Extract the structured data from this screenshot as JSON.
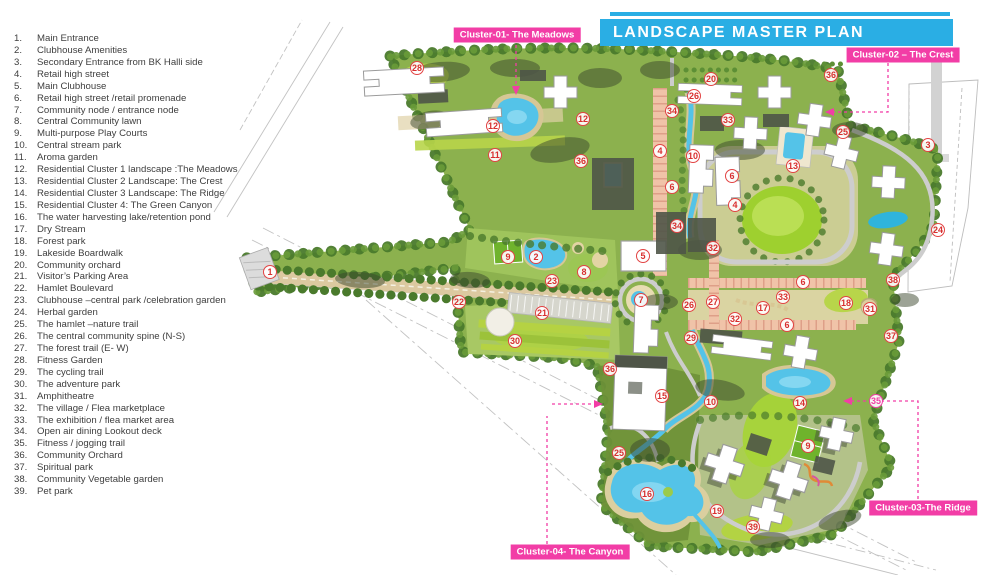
{
  "title": "LANDSCAPE MASTER PLAN",
  "colors": {
    "banner_cyan": "#2aaee4",
    "cluster_label_magenta": "#f23da6",
    "marker_red": "#d82f2f",
    "site_green": "#8cb14e",
    "water_blue": "#54c3e8"
  },
  "legend": {
    "items": [
      {
        "n": "1.",
        "t": "Main Entrance"
      },
      {
        "n": "2.",
        "t": "Clubhouse Amenities"
      },
      {
        "n": "3.",
        "t": "Secondary Entrance from BK Halli side"
      },
      {
        "n": "4.",
        "t": "Retail high street"
      },
      {
        "n": "5.",
        "t": "Main Clubhouse"
      },
      {
        "n": "6.",
        "t": "Retail high street /retail promenade"
      },
      {
        "n": "7.",
        "t": "Community node / entrance node"
      },
      {
        "n": "8.",
        "t": "Central Community lawn"
      },
      {
        "n": "9.",
        "t": "Multi-purpose Play Courts"
      },
      {
        "n": "10.",
        "t": "Central stream park"
      },
      {
        "n": "11.",
        "t": "Aroma garden"
      },
      {
        "n": "12.",
        "t": "Residential Cluster 1 landscape :The Meadows"
      },
      {
        "n": "13.",
        "t": "Residential Cluster 2 Landscape: The Crest"
      },
      {
        "n": "14.",
        "t": "Residential Cluster 3 Landscape: The Ridge"
      },
      {
        "n": "15.",
        "t": "Residential Cluster 4: The Green Canyon"
      },
      {
        "n": "16.",
        "t": "The water harvesting lake/retention pond"
      },
      {
        "n": "17.",
        "t": "Dry Stream"
      },
      {
        "n": "18.",
        "t": "Forest park"
      },
      {
        "n": "19.",
        "t": "Lakeside Boardwalk"
      },
      {
        "n": "20.",
        "t": "Community orchard"
      },
      {
        "n": "21.",
        "t": "Visitor’s Parking Area"
      },
      {
        "n": "22.",
        "t": "Hamlet Boulevard"
      },
      {
        "n": "23.",
        "t": "Clubhouse –central park /celebration garden"
      },
      {
        "n": "24.",
        "t": "Herbal garden"
      },
      {
        "n": "25.",
        "t": "The hamlet –nature trail"
      },
      {
        "n": "26.",
        "t": "The central community spine  (N-S)"
      },
      {
        "n": "27.",
        "t": "The forest trail (E- W)"
      },
      {
        "n": "28.",
        "t": "Fitness Garden"
      },
      {
        "n": "29.",
        "t": "The cycling trail"
      },
      {
        "n": "30.",
        "t": "The adventure park"
      },
      {
        "n": "31.",
        "t": "Amphitheatre"
      },
      {
        "n": "32.",
        "t": "The village / Flea  marketplace"
      },
      {
        "n": "33.",
        "t": "The exhibition / flea market area"
      },
      {
        "n": "34.",
        "t": "Open air dining Lookout deck"
      },
      {
        "n": "35.",
        "t": "Fitness / jogging trail"
      },
      {
        "n": "36.",
        "t": "Community Orchard"
      },
      {
        "n": "37.",
        "t": "Spiritual park"
      },
      {
        "n": "38.",
        "t": "Community Vegetable garden"
      },
      {
        "n": "39.",
        "t": "Pet park"
      }
    ]
  },
  "map": {
    "markers": [
      {
        "n": "28",
        "x": 417,
        "y": 68
      },
      {
        "n": "12",
        "x": 493,
        "y": 126
      },
      {
        "n": "11",
        "x": 495,
        "y": 155
      },
      {
        "n": "12",
        "x": 583,
        "y": 119
      },
      {
        "n": "36",
        "x": 581,
        "y": 161
      },
      {
        "n": "20",
        "x": 711,
        "y": 79
      },
      {
        "n": "26",
        "x": 694,
        "y": 96
      },
      {
        "n": "34",
        "x": 672,
        "y": 111
      },
      {
        "n": "33",
        "x": 728,
        "y": 120
      },
      {
        "n": "36",
        "x": 831,
        "y": 75
      },
      {
        "n": "25",
        "x": 843,
        "y": 132
      },
      {
        "n": "3",
        "x": 928,
        "y": 145
      },
      {
        "n": "4",
        "x": 660,
        "y": 151
      },
      {
        "n": "10",
        "x": 693,
        "y": 156
      },
      {
        "n": "6",
        "x": 672,
        "y": 187
      },
      {
        "n": "6",
        "x": 732,
        "y": 176
      },
      {
        "n": "4",
        "x": 735,
        "y": 205
      },
      {
        "n": "13",
        "x": 793,
        "y": 166
      },
      {
        "n": "34",
        "x": 677,
        "y": 226
      },
      {
        "n": "32",
        "x": 713,
        "y": 248
      },
      {
        "n": "24",
        "x": 938,
        "y": 230
      },
      {
        "n": "1",
        "x": 270,
        "y": 272
      },
      {
        "n": "22",
        "x": 459,
        "y": 302
      },
      {
        "n": "9",
        "x": 508,
        "y": 257
      },
      {
        "n": "2",
        "x": 536,
        "y": 257
      },
      {
        "n": "23",
        "x": 552,
        "y": 281
      },
      {
        "n": "8",
        "x": 584,
        "y": 272
      },
      {
        "n": "21",
        "x": 542,
        "y": 313
      },
      {
        "n": "30",
        "x": 515,
        "y": 341
      },
      {
        "n": "5",
        "x": 643,
        "y": 256
      },
      {
        "n": "7",
        "x": 641,
        "y": 300
      },
      {
        "n": "6",
        "x": 803,
        "y": 282
      },
      {
        "n": "33",
        "x": 783,
        "y": 297
      },
      {
        "n": "26",
        "x": 689,
        "y": 305
      },
      {
        "n": "27",
        "x": 713,
        "y": 302
      },
      {
        "n": "17",
        "x": 763,
        "y": 308
      },
      {
        "n": "18",
        "x": 846,
        "y": 303
      },
      {
        "n": "31",
        "x": 870,
        "y": 309
      },
      {
        "n": "38",
        "x": 893,
        "y": 280
      },
      {
        "n": "32",
        "x": 735,
        "y": 319
      },
      {
        "n": "6",
        "x": 787,
        "y": 325
      },
      {
        "n": "37",
        "x": 891,
        "y": 336
      },
      {
        "n": "29",
        "x": 691,
        "y": 338
      },
      {
        "n": "36",
        "x": 610,
        "y": 369
      },
      {
        "n": "15",
        "x": 662,
        "y": 396
      },
      {
        "n": "10",
        "x": 711,
        "y": 402
      },
      {
        "n": "14",
        "x": 800,
        "y": 403
      },
      {
        "n": "35",
        "x": 876,
        "y": 401,
        "v": "magenta"
      },
      {
        "n": "25",
        "x": 619,
        "y": 453
      },
      {
        "n": "16",
        "x": 647,
        "y": 494
      },
      {
        "n": "9",
        "x": 808,
        "y": 446
      },
      {
        "n": "19",
        "x": 717,
        "y": 511
      },
      {
        "n": "39",
        "x": 753,
        "y": 527
      }
    ],
    "cluster_labels": [
      {
        "id": "cluster-01",
        "text": "Cluster-01- The Meadows",
        "x": 517,
        "y": 35
      },
      {
        "id": "cluster-02",
        "text": "Cluster-02 – The Crest",
        "x": 903,
        "y": 55
      },
      {
        "id": "cluster-03",
        "text": "Cluster-03-The Ridge",
        "x": 923,
        "y": 508
      },
      {
        "id": "cluster-04",
        "text": "Cluster-04- The Canyon",
        "x": 570,
        "y": 552
      }
    ]
  }
}
